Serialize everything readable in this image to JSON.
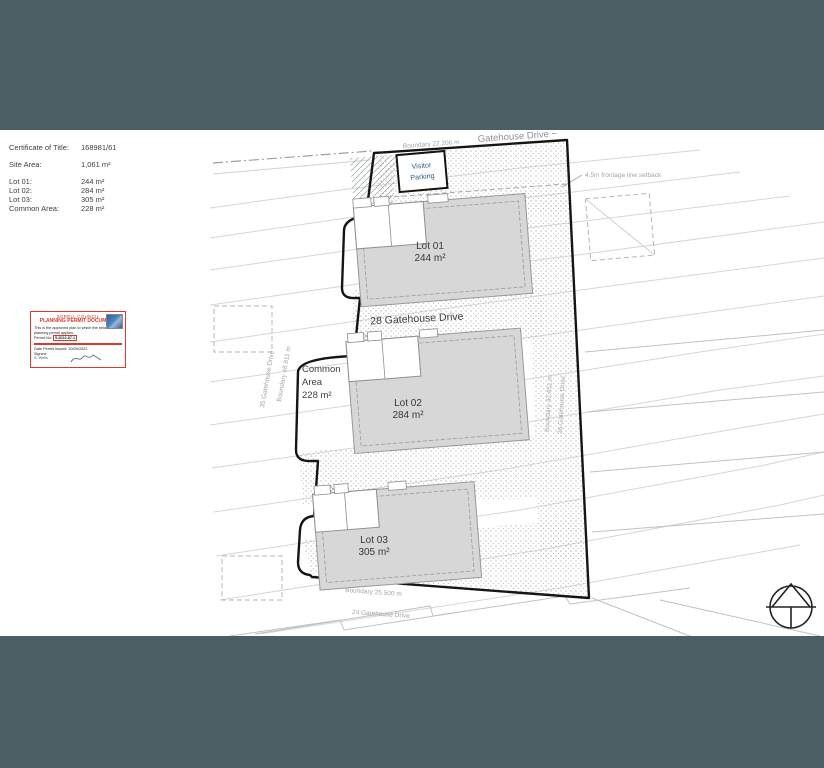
{
  "page": {
    "backdrop_color": "#4b5e63",
    "paper_color": "#ffffff"
  },
  "title_block": {
    "certificate_label": "Certificate of Title:",
    "certificate_value": "168981/61",
    "site_area_label": "Site Area:",
    "site_area_value": "1,061 m²",
    "rows": [
      {
        "label": "Lot 01:",
        "value": "244 m²"
      },
      {
        "label": "Lot 02:",
        "value": "284 m²"
      },
      {
        "label": "Lot 03:",
        "value": "305 m²"
      },
      {
        "label": "Common Area:",
        "value": "228 m²"
      }
    ]
  },
  "stamp": {
    "council": "SORELL COUNCIL",
    "title": "PLANNING PERMIT DOCUMENT",
    "body1": "This is the approved plan to which the below",
    "body2": "planning permit applies.",
    "permit_label": "Permit No:",
    "permit_no": "5.2022.87.1",
    "issued": "Date Permit Issued: 20/09/2022",
    "signed_label": "Signed:",
    "signer": "S. Wells",
    "accent_color": "#d93a2b"
  },
  "plan": {
    "street_label": "Gatehouse Drive ~",
    "boundary_top": "Boundary 22.206 m",
    "setback_label": "4.5m frontage line setback",
    "visitor_parking_line1": "Visitor",
    "visitor_parking_line2": "Parking",
    "address_label": "28 Gatehouse Drive",
    "lots": [
      {
        "name": "Lot 01",
        "area": "244 m²"
      },
      {
        "name": "Lot 02",
        "area": "284 m²"
      },
      {
        "name": "Lot 03",
        "area": "305 m²"
      }
    ],
    "common_area": {
      "line1": "Common",
      "line2": "Area",
      "line3": "228 m²"
    },
    "boundary_left": "Boundary 48.811 m",
    "neighbor_left": "35 Gatehouse Drive",
    "boundary_right": "Boundary 47.451 m",
    "neighbor_right": "26 Gatehouse Drive",
    "boundary_bottom": "Boundary 25.500 m",
    "neighbor_bottom": "24 Gatehouse Drive"
  }
}
